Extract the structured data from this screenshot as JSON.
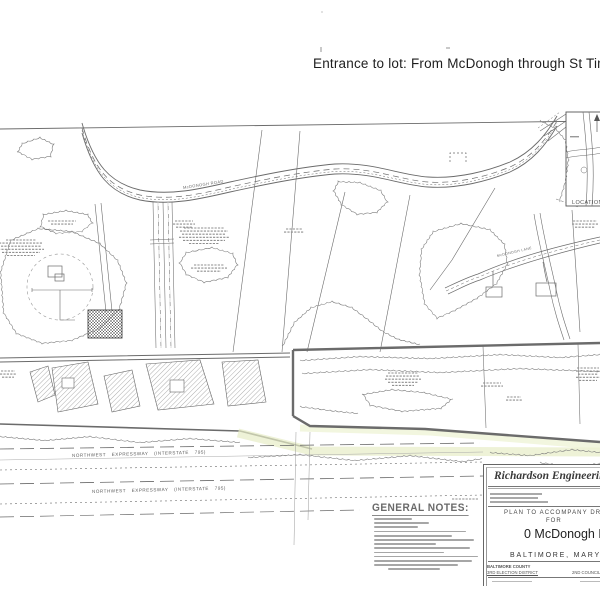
{
  "colors": {
    "ink": "#555555",
    "highlight": "#e7edc6",
    "paper": "#ffffff"
  },
  "annotation": {
    "text": "Entrance to lot: From McDonogh through St Timothys"
  },
  "map": {
    "road_label": "McDONOGH ROAD",
    "lane_label": "McDONOGH LANE",
    "location_map_label": "LOCATION MAP",
    "expressway_upper": "NORTHWEST EXPRESSWAY (INTERSTATE 795)",
    "expressway_lower": "NORTHWEST EXPRESSWAY (INTERSTATE 795)",
    "general_notes_heading": "GENERAL NOTES:"
  },
  "title_block": {
    "firm": "Richardson Engineering",
    "plan_line": "PLAN TO ACCOMPANY DRC",
    "for_line": "FOR",
    "project": "0 McDonogh Rd",
    "city": "BALTIMORE, MARYLAND",
    "county": "BALTIMORE COUNTY",
    "district": "3RD ELECTION DISTRICT",
    "council": "2ND COUNCIL"
  }
}
